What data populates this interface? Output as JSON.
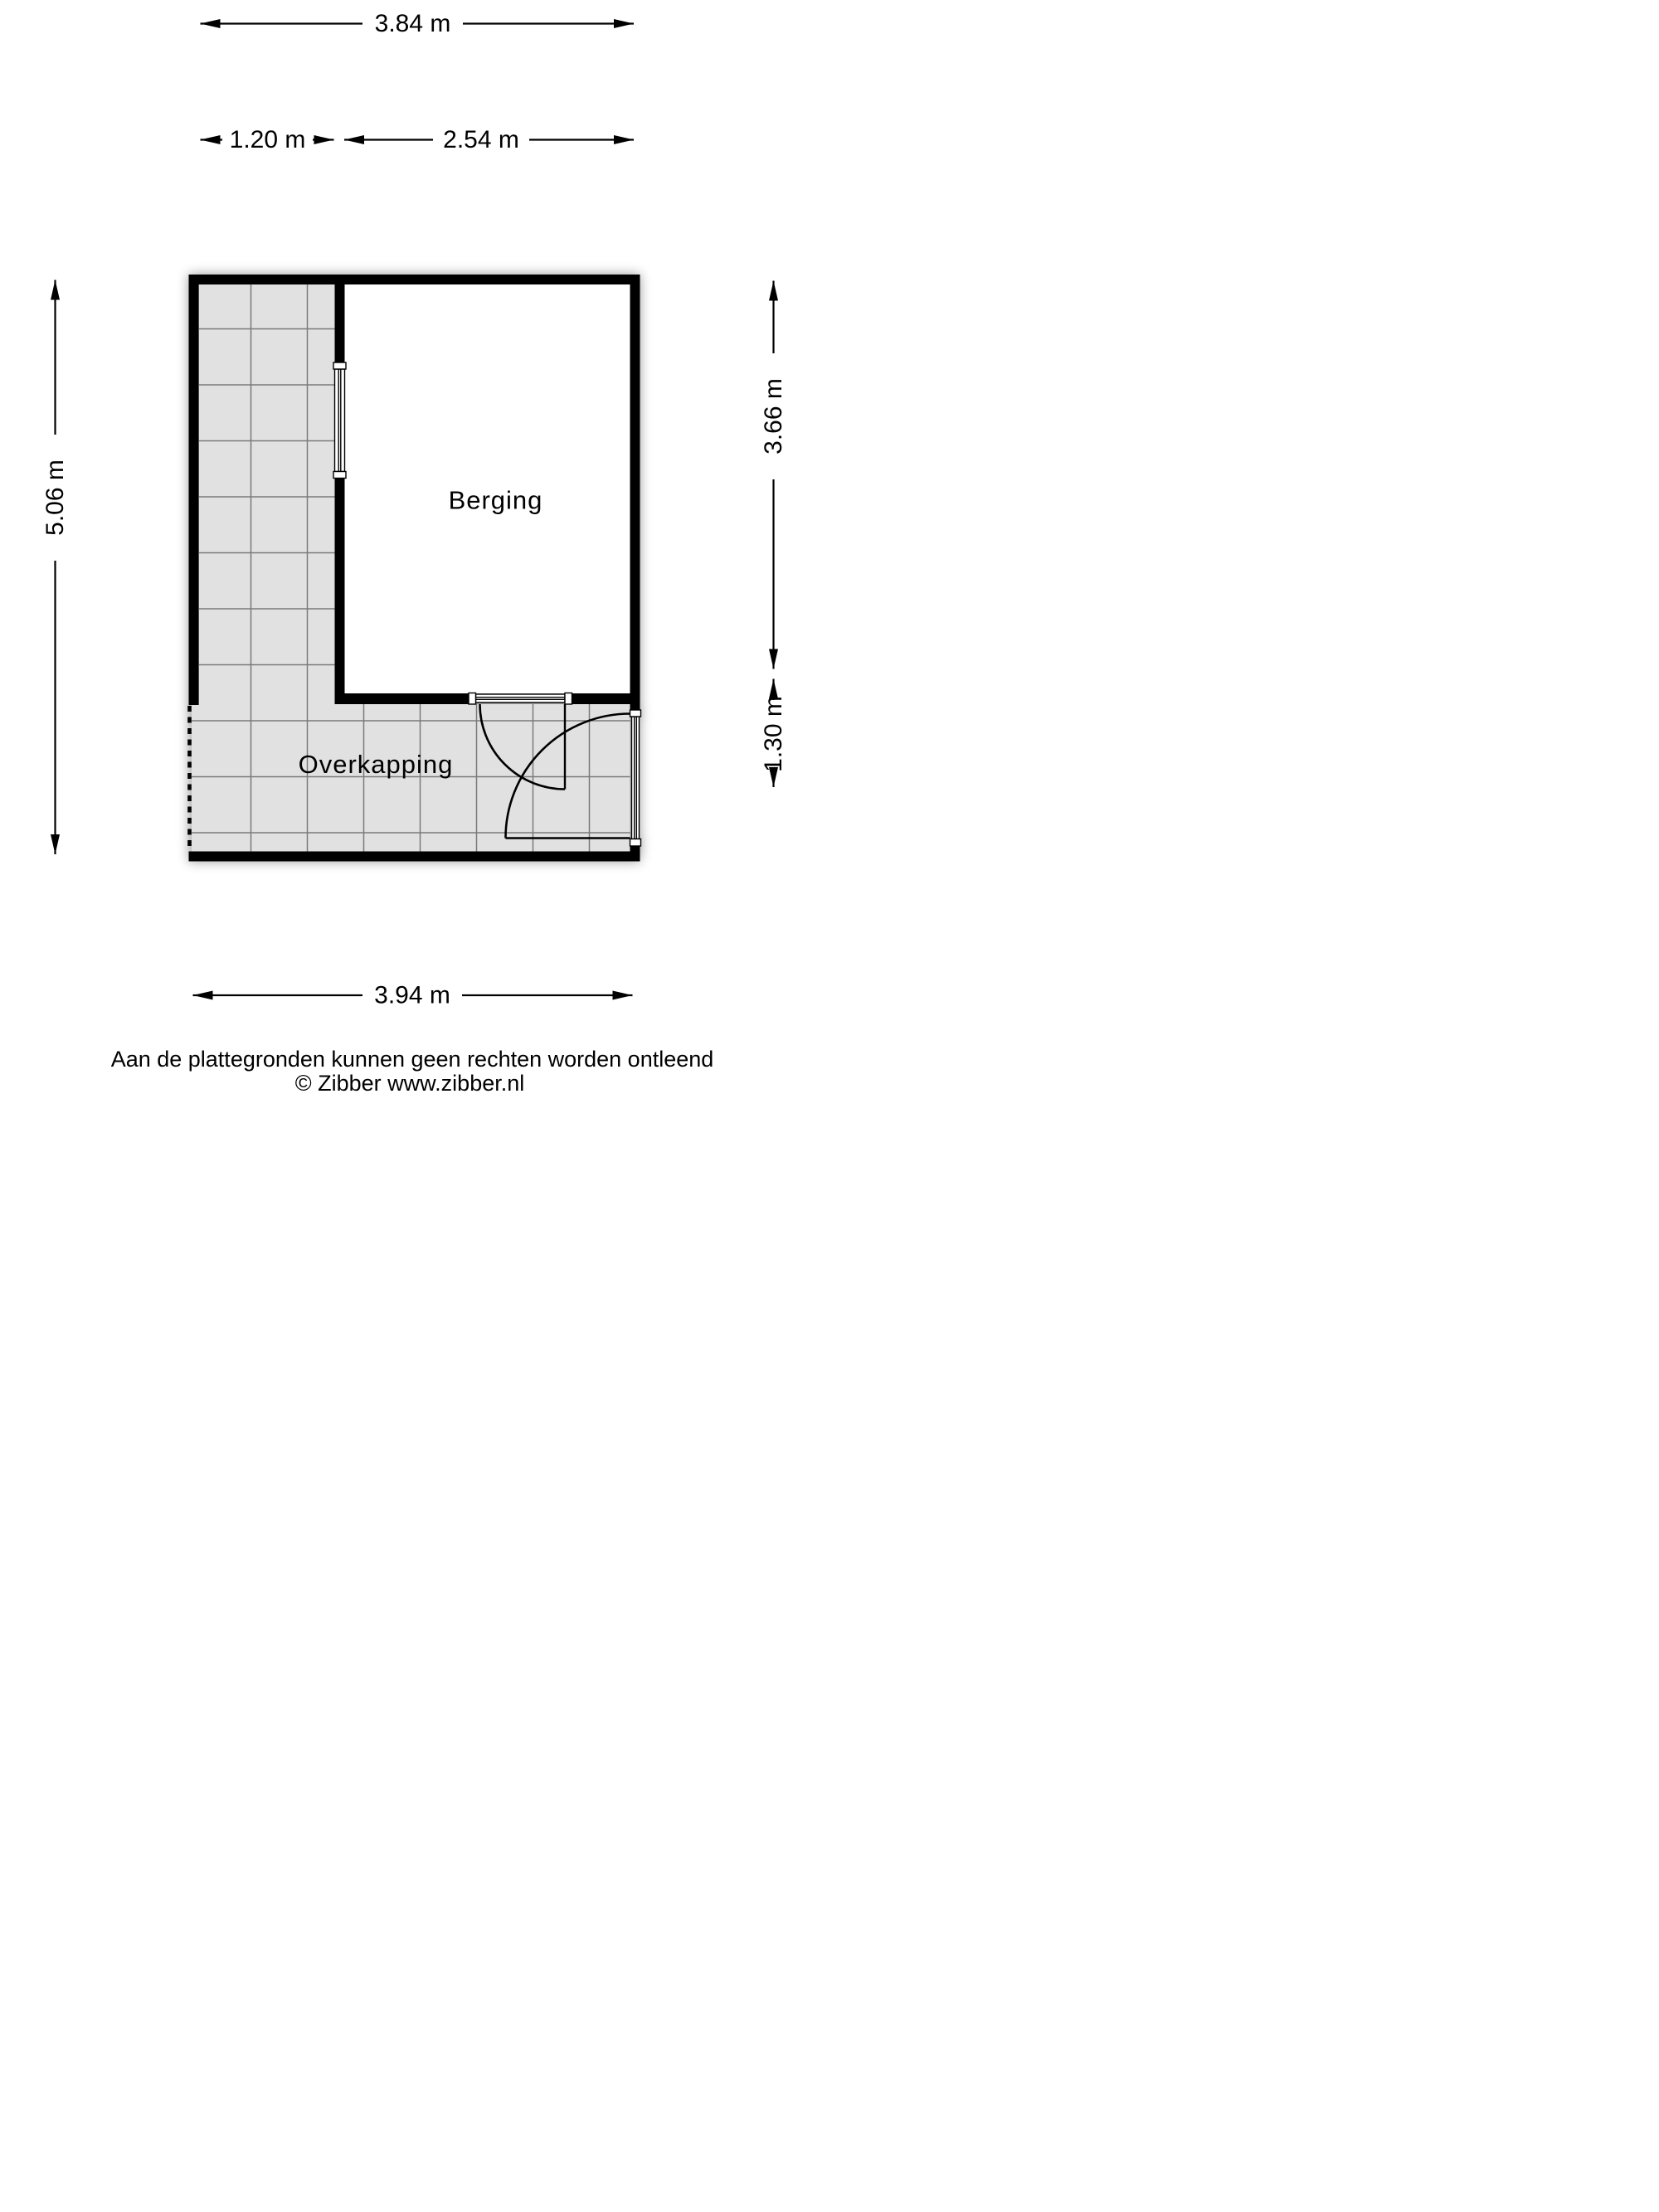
{
  "floorplan": {
    "rooms": [
      {
        "label": "Berging"
      },
      {
        "label": "Overkapping"
      }
    ],
    "dimensions": {
      "top_total": "3.84 m",
      "top_left": "1.20 m",
      "top_right": "2.54 m",
      "left_total": "5.06 m",
      "right_upper": "3.66 m",
      "right_lower": "1.30 m",
      "bottom_total": "3.94 m"
    },
    "colors": {
      "wall": "#000000",
      "tile_fill": "#e1e1e1",
      "tile_line": "#7a7a7a",
      "room_fill": "#ffffff"
    }
  },
  "footer": {
    "disclaimer": "Aan de plattegronden kunnen geen rechten worden ontleend",
    "copyright": "© Zibber www.zibber.nl"
  }
}
